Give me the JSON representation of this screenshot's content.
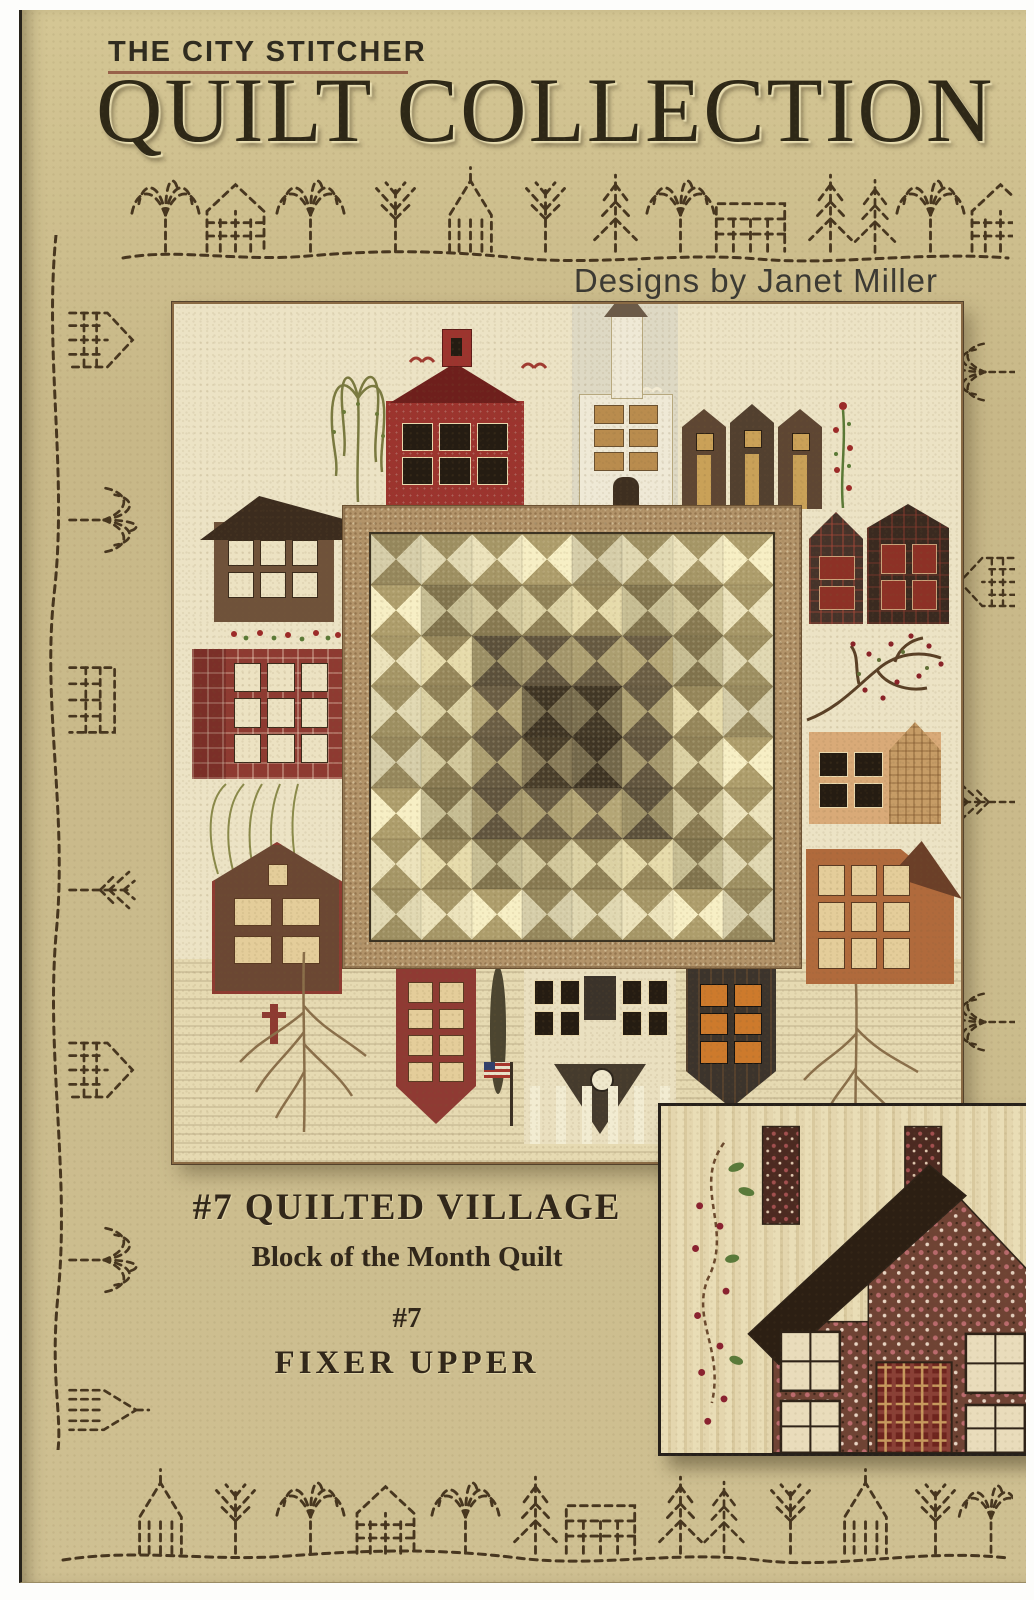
{
  "page": {
    "brand": "THE CITY STITCHER",
    "title": "QUILT COLLECTION",
    "byline": "Designs by Janet Miller",
    "pattern_title": "#7 QUILTED VILLAGE",
    "pattern_subtitle": "Block of the Month Quilt",
    "block_number": "#7",
    "block_name": "FIXER UPPER"
  },
  "colors": {
    "page_background": "#c9ba8c",
    "title_ink": "#2e2817",
    "stitch_ink": "#47361f",
    "brand_underline": "#8a4a38",
    "photo_background": "#ece3c5",
    "photo_border": "#8a6a44",
    "medallion_frame": "#b3946a",
    "schoolhouse_red": "#9c342e",
    "church_white": "#efe9d6",
    "rust_house": "#b06a3c",
    "inset_border": "#26201a"
  },
  "medallion": {
    "rows": 8,
    "cols": 8,
    "rings": [
      {
        "side": "#e7dfb8",
        "point": "#a29364"
      },
      {
        "side": "#d7cda0",
        "point": "#8b7d54"
      },
      {
        "side": "#a89b6e",
        "point": "#635740"
      },
      {
        "side": "#7c7050",
        "point": "#433927"
      }
    ]
  },
  "decor": {
    "border_motifs": [
      "stitched-house",
      "stitched-church",
      "stitched-willow",
      "stitched-pine",
      "stitched-tree",
      "stitched-barn"
    ]
  }
}
